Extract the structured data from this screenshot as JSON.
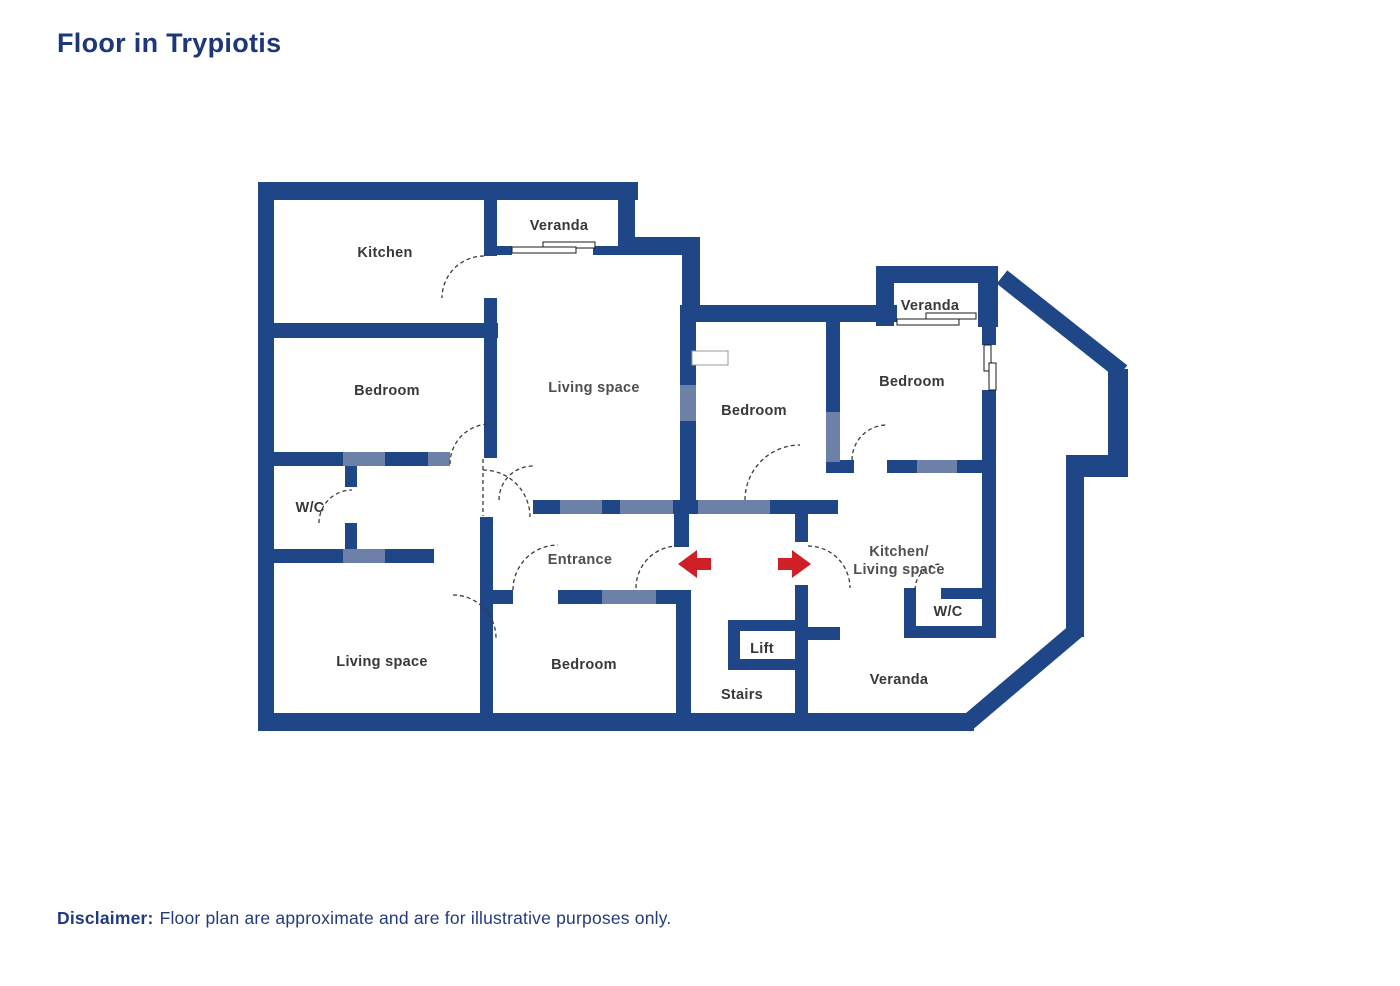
{
  "title": "Floor in Trypiotis",
  "disclaimer": {
    "label": "Disclaimer:",
    "text": "Floor plan are approximate and are for illustrative purposes only."
  },
  "colors": {
    "wall_navy": "#1f4787",
    "door_lintel_blue": "#6d80a8",
    "door_arc_gray": "#3a3a3a",
    "entrance_arrow_red": "#cf2027",
    "room_label_gray": "#383838",
    "title_navy": "#1e3779"
  },
  "rooms": {
    "kitchen": "Kitchen",
    "veranda_top": "Veranda",
    "living_main": "Living space",
    "bedroom_left": "Bedroom",
    "wc_left": "W/C",
    "entrance": "Entrance",
    "living_lower": "Living space",
    "bedroom_bottom": "Bedroom",
    "bedroom_middle": "Bedroom",
    "veranda_right": "Veranda",
    "bedroom_right": "Bedroom",
    "kitchen_living_line1": "Kitchen/",
    "kitchen_living_line2": "Living space",
    "wc_right": "W/C",
    "lift": "Lift",
    "stairs": "Stairs",
    "veranda_bottom": "Veranda"
  }
}
